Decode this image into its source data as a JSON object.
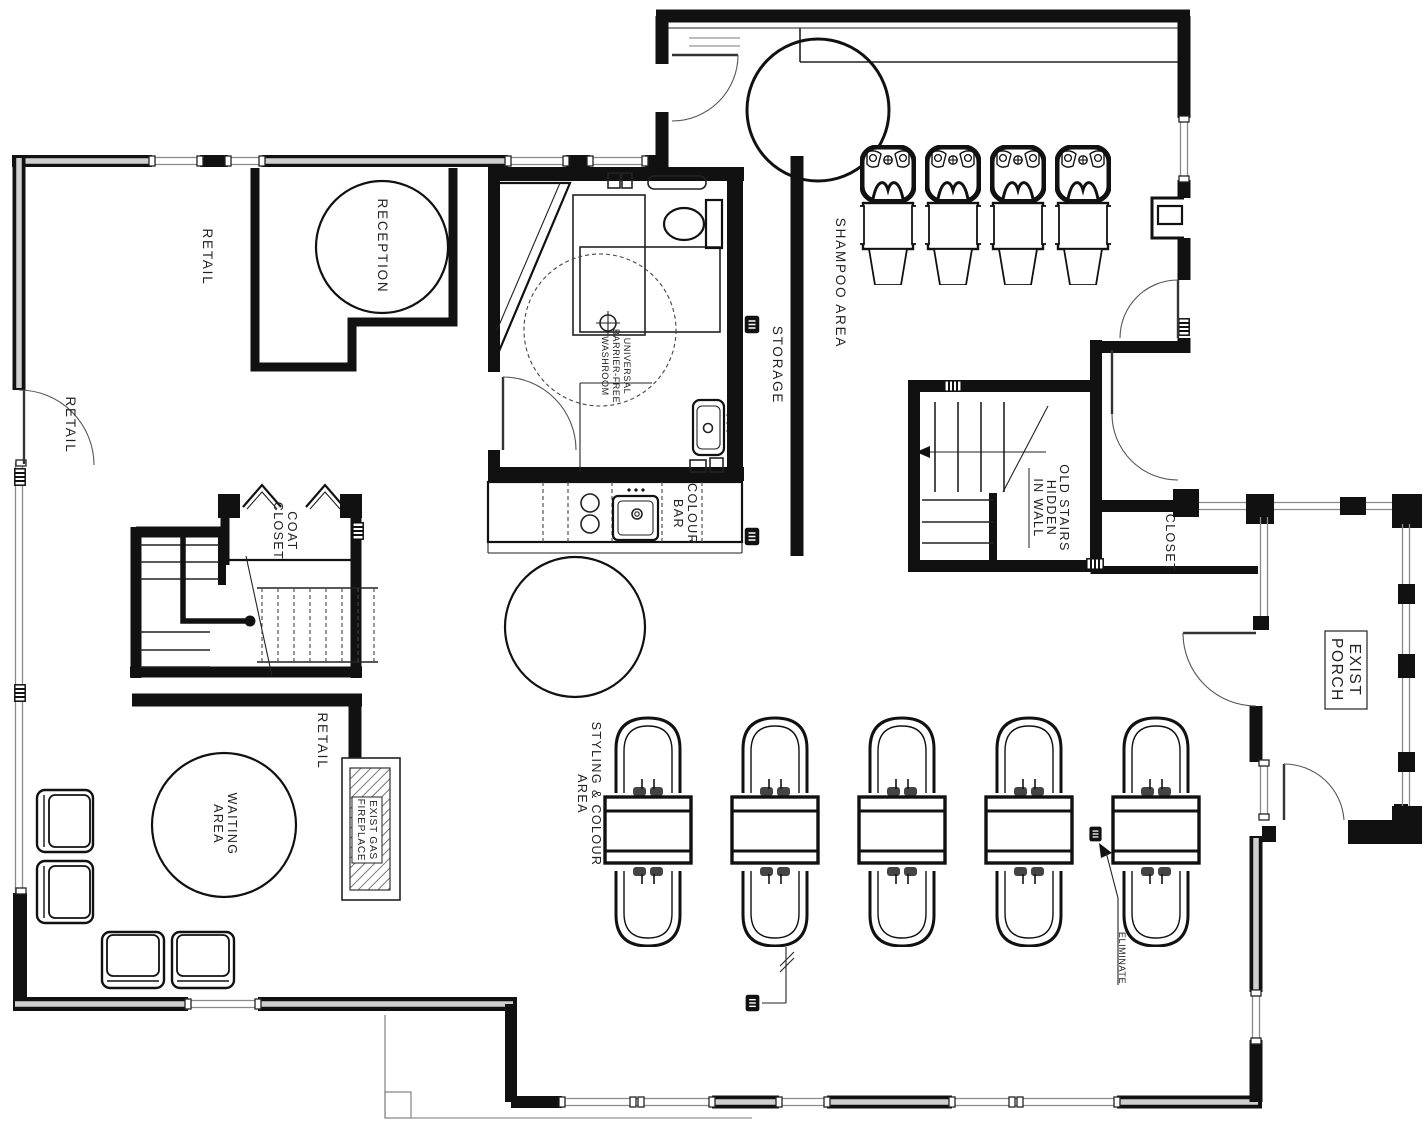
{
  "plan": {
    "kind": "salon main-floor plan",
    "labels": {
      "retail_top": "RETAIL",
      "retail_left": "RETAIL",
      "retail_mid": "RETAIL",
      "reception": "RECEPTION",
      "washroom": [
        "UNIVERSAL",
        "BARRIER-FREE",
        "WASHROOM"
      ],
      "storage": "STORAGE",
      "shampoo_area": "SHAMPOO AREA",
      "colour_bar": [
        "COLOUR",
        "BAR"
      ],
      "old_stairs": [
        "OLD STAIRS",
        "HIDDEN",
        "IN WALL"
      ],
      "closet": "CLOSET",
      "exist_porch": [
        "EXIST",
        "PORCH"
      ],
      "coat_closet": [
        "COAT",
        "CLOSET"
      ],
      "waiting_area": [
        "WAITING",
        "AREA"
      ],
      "fireplace": [
        "EXIST GAS",
        "FIREPLACE"
      ],
      "styling_area": [
        "STYLING & COLOUR",
        "AREA"
      ],
      "eliminate": "ELIMINATE"
    },
    "colors": {
      "line": "#111111",
      "window": "#8a8a8a",
      "wall_core": "#cfcfcf",
      "paper": "#ffffff"
    },
    "counts": {
      "shampoo_stations": 4,
      "styling_stations": 5,
      "waiting_chairs": 4
    }
  }
}
